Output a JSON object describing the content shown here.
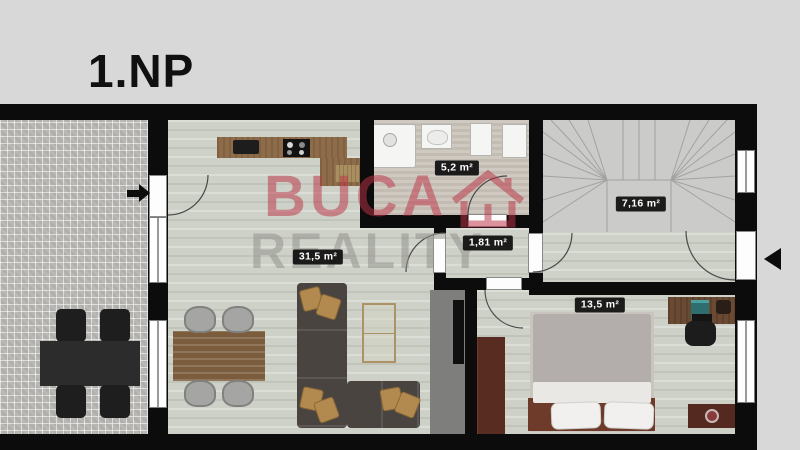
{
  "header": {
    "title": "1.NP"
  },
  "watermark": {
    "brand_line1": "BUCA",
    "brand_line2": "REALITY",
    "house_icon": "house-icon",
    "color_red": "#bb3446",
    "color_gray": "#94928c"
  },
  "rooms": {
    "living_room_kitchen": {
      "area_label": "31,5 m²"
    },
    "bathroom": {
      "area_label": "5,2 m²"
    },
    "hallway": {
      "area_label": "1,81 m²"
    },
    "staircase": {
      "area_label": "7,16 m²"
    },
    "bedroom": {
      "area_label": "13,5 m²"
    }
  },
  "icons": {
    "terrace_entry_arrow": "right-arrow-icon",
    "main_entry_arrow": "left-arrow-icon"
  },
  "colors": {
    "background": "#d8d8d8",
    "wall": "#0c0c0c",
    "wood_floor": "#cdd1c8",
    "terrace_paving": "#b9b8b4"
  }
}
